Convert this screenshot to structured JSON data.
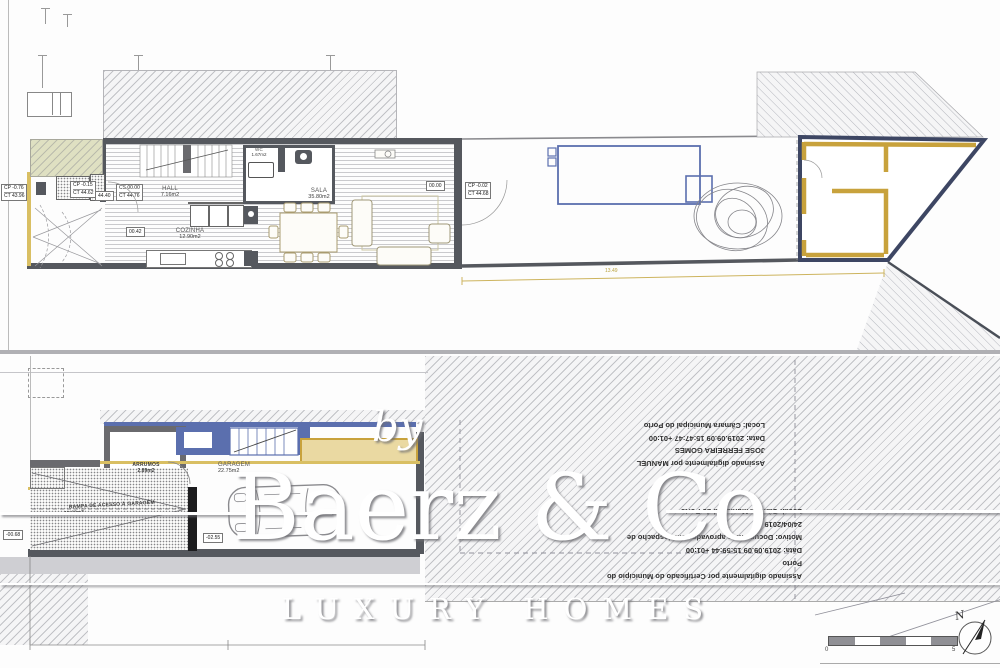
{
  "colors": {
    "wall_dark": "#55585e",
    "wall_blue": "#5b6fae",
    "wall_yellow": "#c8a23c",
    "fill_tan": "#ead9a2",
    "outline_navy": "#3d4663",
    "dim_yellow": "#b9a23c"
  },
  "watermark": {
    "by": "by",
    "brand": "Baerz & Co",
    "tagline": "LUXURY HOMES"
  },
  "upper": {
    "rooms": {
      "hall": {
        "name": "HALL",
        "area": "7.16m2"
      },
      "wc": {
        "name": "WC",
        "area": "1.67m2"
      },
      "cozinha": {
        "name": "COZINHA",
        "area": "12.90m2"
      },
      "sala": {
        "name": "SALA",
        "area": "35.80m2"
      }
    },
    "levels": {
      "a1": "CP -0.76",
      "a2": "CT 43.96",
      "b1": "CP -0.15",
      "b2": "CT 44.62",
      "c1": "CS 00.00",
      "c2": "CT 44.76",
      "d1": "CP -0.02",
      "d2": "CT 44.68"
    },
    "spots": {
      "s1": "44.40",
      "s2": "00.42",
      "s3": "00.00"
    },
    "dim": "13.49"
  },
  "lower": {
    "rooms": {
      "arrumos": {
        "name": "ARRUMOS",
        "area": "2.89m2"
      },
      "garagem": {
        "name": "GARAGEM",
        "area": "22.75m2"
      },
      "rampa": {
        "name": "RAMPA DE ACESSO À GARAGEM",
        "area": "13.60m2"
      }
    },
    "spots": {
      "left": "-00.68",
      "garage": "-02.55"
    }
  },
  "signatures": {
    "manuel": {
      "l1": "Assinado digitalmente por MANUEL",
      "l2": "JOSE FERREIRA GOMES",
      "l3": "Data: 2019.09.09 15:47:47 +01:00",
      "l4": "Local: Câmara Municipal do Porto"
    },
    "municipio": {
      "l1": "Assinado digitalmente por Certificado do Município do",
      "l2": "Porto",
      "l3": "Data: 2019.09.09 15:59:44 +01:00",
      "l4": "Motivo: Documentos aprovados em despacho de",
      "l5": "24/04/2019",
      "l6": "Local: Câmara Municipal do Porto"
    }
  },
  "scalebar": {
    "zero": "0",
    "five": "5"
  },
  "north": {
    "label": "N"
  }
}
